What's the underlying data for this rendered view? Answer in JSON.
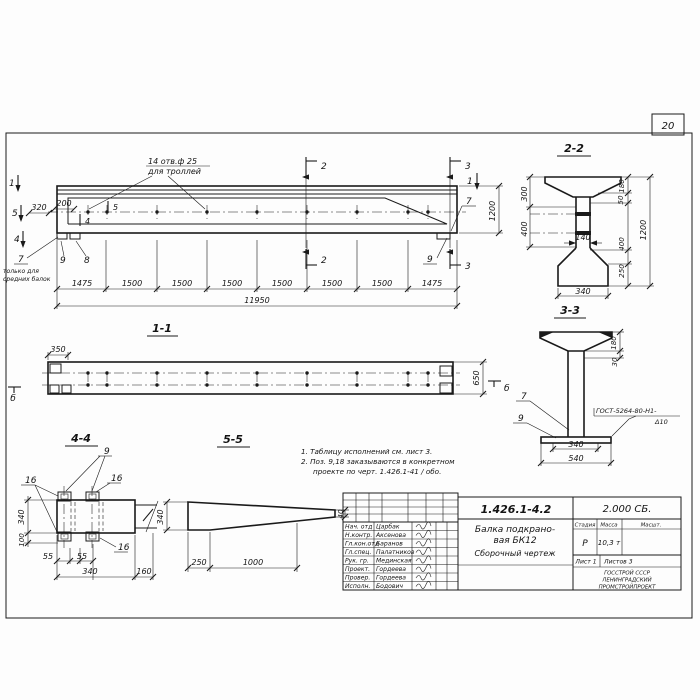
{
  "sheet": {
    "page_number": "20"
  },
  "main_view": {
    "callout_holes_l1": "14 отв.ф 25",
    "callout_holes_l2": "для троллей",
    "dim_320": "320",
    "dim_200": "200",
    "cut5_inner": "5",
    "cut4_inner": "4",
    "marker_1_left": "1",
    "marker_5_left": "5",
    "marker_4_left": "4",
    "marker_2_top": "2",
    "marker_3_top": "3",
    "marker_1_right": "1",
    "marker_2_bottom": "2",
    "marker_3_bottom": "3",
    "pos_7_left": "7",
    "pos_9_left": "9",
    "pos_8": "8",
    "pos_7_right": "7",
    "pos_9_right": "9",
    "note_left_l1": "только для",
    "note_left_l2": "средних балок",
    "dim_height": "1200",
    "segments": [
      "1475",
      "1500",
      "1500",
      "1500",
      "1500",
      "1500",
      "1500",
      "1475"
    ],
    "dim_total": "11950"
  },
  "section_1_1": {
    "title": "1-1",
    "dim_350": "350",
    "dim_650": "650",
    "marker_b_left": "б",
    "marker_b_right": "б"
  },
  "section_2_2": {
    "title": "2-2",
    "dim_300": "300",
    "dim_400_left": "400",
    "dim_140": "140",
    "dim_180": "180",
    "dim_50": "50",
    "dim_1200": "1200",
    "dim_400_right": "400",
    "dim_250": "250",
    "dim_340": "340"
  },
  "section_3_3": {
    "title": "3-3",
    "dim_180": "180",
    "dim_30": "30",
    "pos_7": "7",
    "pos_9": "9",
    "weld_l1": "ГОСТ-5264-80-Н1-",
    "weld_l2": "Δ10",
    "dim_340": "340",
    "dim_540": "540"
  },
  "section_4_4": {
    "title": "4-4",
    "pos_9": "9",
    "pos_16_a": "16",
    "pos_16_b": "16",
    "pos_16_c": "16",
    "dim_340_left": "340",
    "dim_100": "100",
    "dim_55_a": "55",
    "dim_55_b": "55",
    "dim_340_bottom": "340",
    "dim_160": "160"
  },
  "section_5_5": {
    "title": "5-5",
    "dim_340": "340",
    "dim_40": "40",
    "dim_250": "250",
    "dim_1000": "1000"
  },
  "notes": {
    "line1": "1. Таблицу исполнений см. лист 3.",
    "line2": "2. Поз. 9,18 заказываются в конкретном",
    "line3": "проекте по черт. 1.426.1-41 / обо."
  },
  "title_block": {
    "doc_number": "1.426.1-4.2",
    "doc_code": "2.000 СБ.",
    "title_l1": "Балка подкрано-",
    "title_l2": "вая БК12",
    "title_l3": "Сборочный чертеж",
    "stage_header": "Стадия",
    "mass_header": "Масса",
    "scale_header": "Масшт.",
    "stage_value": "Р",
    "mass_value": "10,3 т",
    "sheet_label": "Лист 1",
    "sheets_label": "Листов 3",
    "org_l1": "ГОССТРОЙ СССР",
    "org_l2": "ЛЕНИНГРАДСКИЙ",
    "org_l3": "ПРОМСТРОЙПРОЕКТ",
    "roles": [
      {
        "role": "Нач. отд",
        "name": "Царбак"
      },
      {
        "role": "Н.контр.",
        "name": "Аксенова"
      },
      {
        "role": "Гл.кон.отд",
        "name": "Баранов"
      },
      {
        "role": "Гл.спец.",
        "name": "Палатников"
      },
      {
        "role": "Рук. гр.",
        "name": "Мединская"
      },
      {
        "role": "Проект.",
        "name": "Гордеева"
      },
      {
        "role": "Провер.",
        "name": "Гордеева"
      },
      {
        "role": "Исполн.",
        "name": "Бодович"
      }
    ]
  }
}
